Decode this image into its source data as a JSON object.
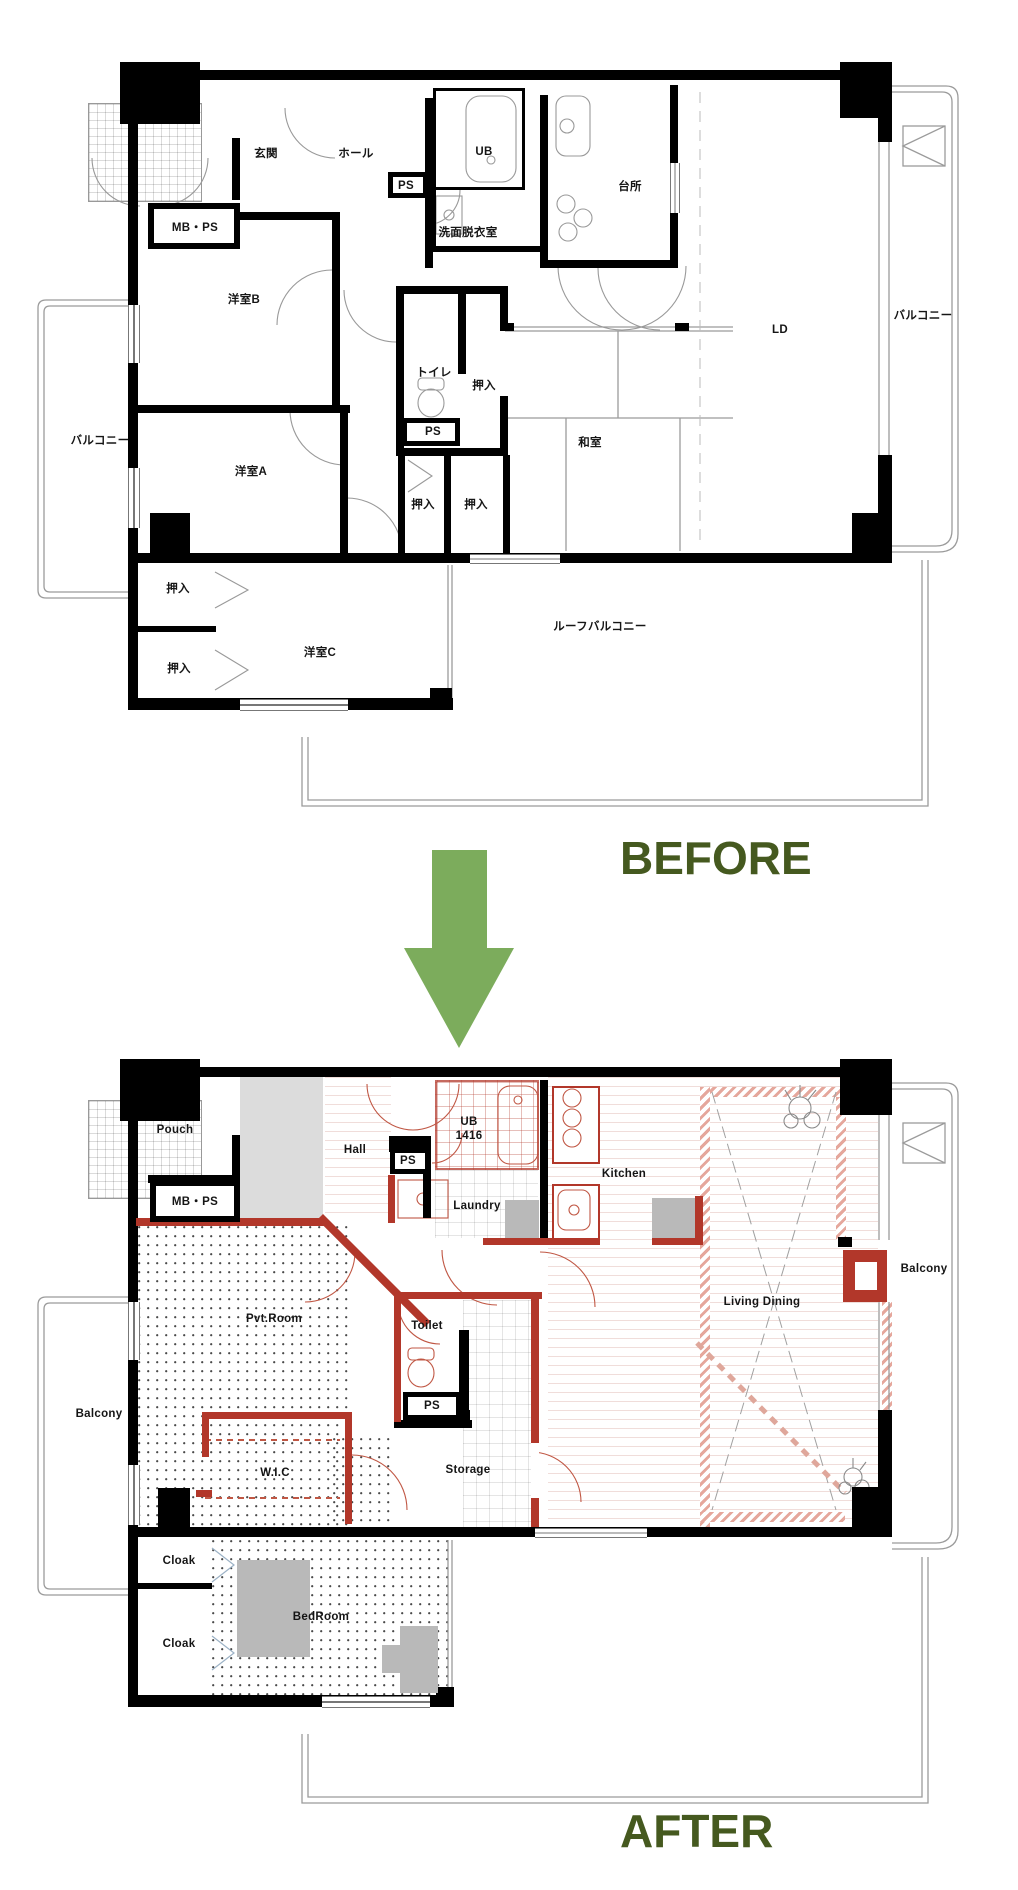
{
  "before_title": "BEFORE",
  "after_title": "AFTER",
  "icons": {
    "transition_arrow": "down-arrow"
  },
  "colors": {
    "wall_black": "#000000",
    "renovation_red": "#b2372a",
    "hatch_pink": "#e5a79c",
    "arrow_green": "#7cac5c",
    "title_green": "#45591f",
    "floor_gray": "#dcdcdc",
    "furniture_gray": "#b9b9b9"
  },
  "before_plan": {
    "rooms": [
      {
        "label": "玄関"
      },
      {
        "label": "ホール"
      },
      {
        "label": "UB"
      },
      {
        "label": "PS"
      },
      {
        "label": "台所"
      },
      {
        "label": "洗面脱衣室"
      },
      {
        "label": "MB・PS"
      },
      {
        "label": "洋室B"
      },
      {
        "label": "LD"
      },
      {
        "label": "バルコニー"
      },
      {
        "label": "トイレ"
      },
      {
        "label": "押入"
      },
      {
        "label": "PS"
      },
      {
        "label": "和室"
      },
      {
        "label": "バルコニー"
      },
      {
        "label": "洋室A"
      },
      {
        "label": "押入"
      },
      {
        "label": "押入"
      },
      {
        "label": "押入"
      },
      {
        "label": "押入"
      },
      {
        "label": "洋室C"
      },
      {
        "label": "ルーフバルコニー"
      }
    ]
  },
  "after_plan": {
    "ub_size": "1416",
    "rooms": [
      {
        "label": "Pouch"
      },
      {
        "label": "Hall"
      },
      {
        "label": "PS"
      },
      {
        "label": "UB"
      },
      {
        "label": "Kitchen"
      },
      {
        "label": "MB・PS"
      },
      {
        "label": "Laundry"
      },
      {
        "label": "Balcony"
      },
      {
        "label": "Living Dining"
      },
      {
        "label": "Pvt.Room"
      },
      {
        "label": "Toilet"
      },
      {
        "label": "Balcony"
      },
      {
        "label": "PS"
      },
      {
        "label": "W.I.C"
      },
      {
        "label": "Storage"
      },
      {
        "label": "Cloak"
      },
      {
        "label": "BedRoom"
      },
      {
        "label": "Cloak"
      }
    ]
  }
}
